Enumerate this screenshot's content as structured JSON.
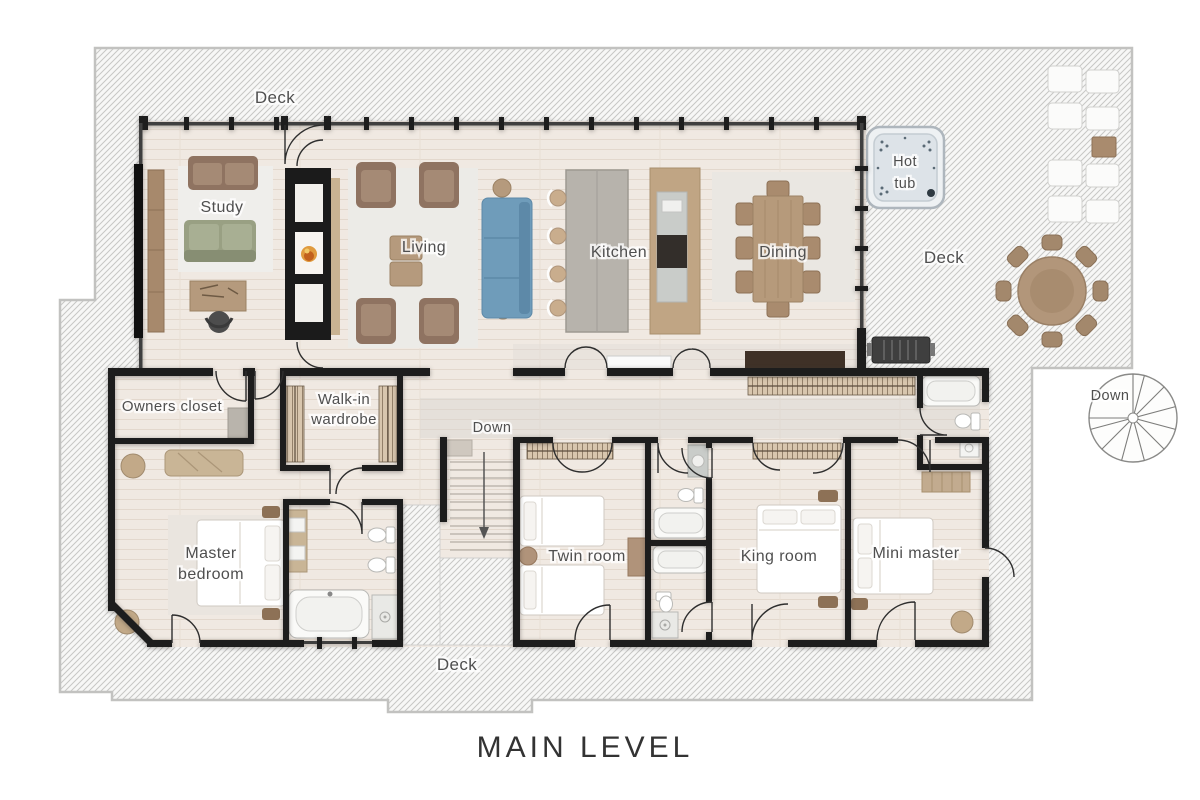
{
  "title": "MAIN LEVEL",
  "labels": {
    "deck_top": "Deck",
    "deck_right": "Deck",
    "deck_bottom": "Deck",
    "down_spiral": "Down",
    "down_stairs": "Down",
    "hot_tub_line1": "Hot",
    "hot_tub_line2": "tub",
    "study": "Study",
    "living": "Living",
    "kitchen": "Kitchen",
    "dining": "Dining",
    "owners_closet": "Owners closet",
    "walk_in_line1": "Walk-in",
    "walk_in_line2": "wardrobe",
    "master_line1": "Master",
    "master_line2": "bedroom",
    "twin_room": "Twin room",
    "king_room": "King room",
    "mini_master": "Mini master"
  },
  "colors": {
    "wall": "#1d1d1d",
    "floor": "#f0e9e2",
    "deck_hatch_line": "#c7c7c5",
    "label_gray": "#4f4f4f",
    "sofa_blue": "#6f9cba",
    "sofa_green": "#99a083",
    "wood": "#b59a7d",
    "chair_brown": "#8f7361"
  }
}
